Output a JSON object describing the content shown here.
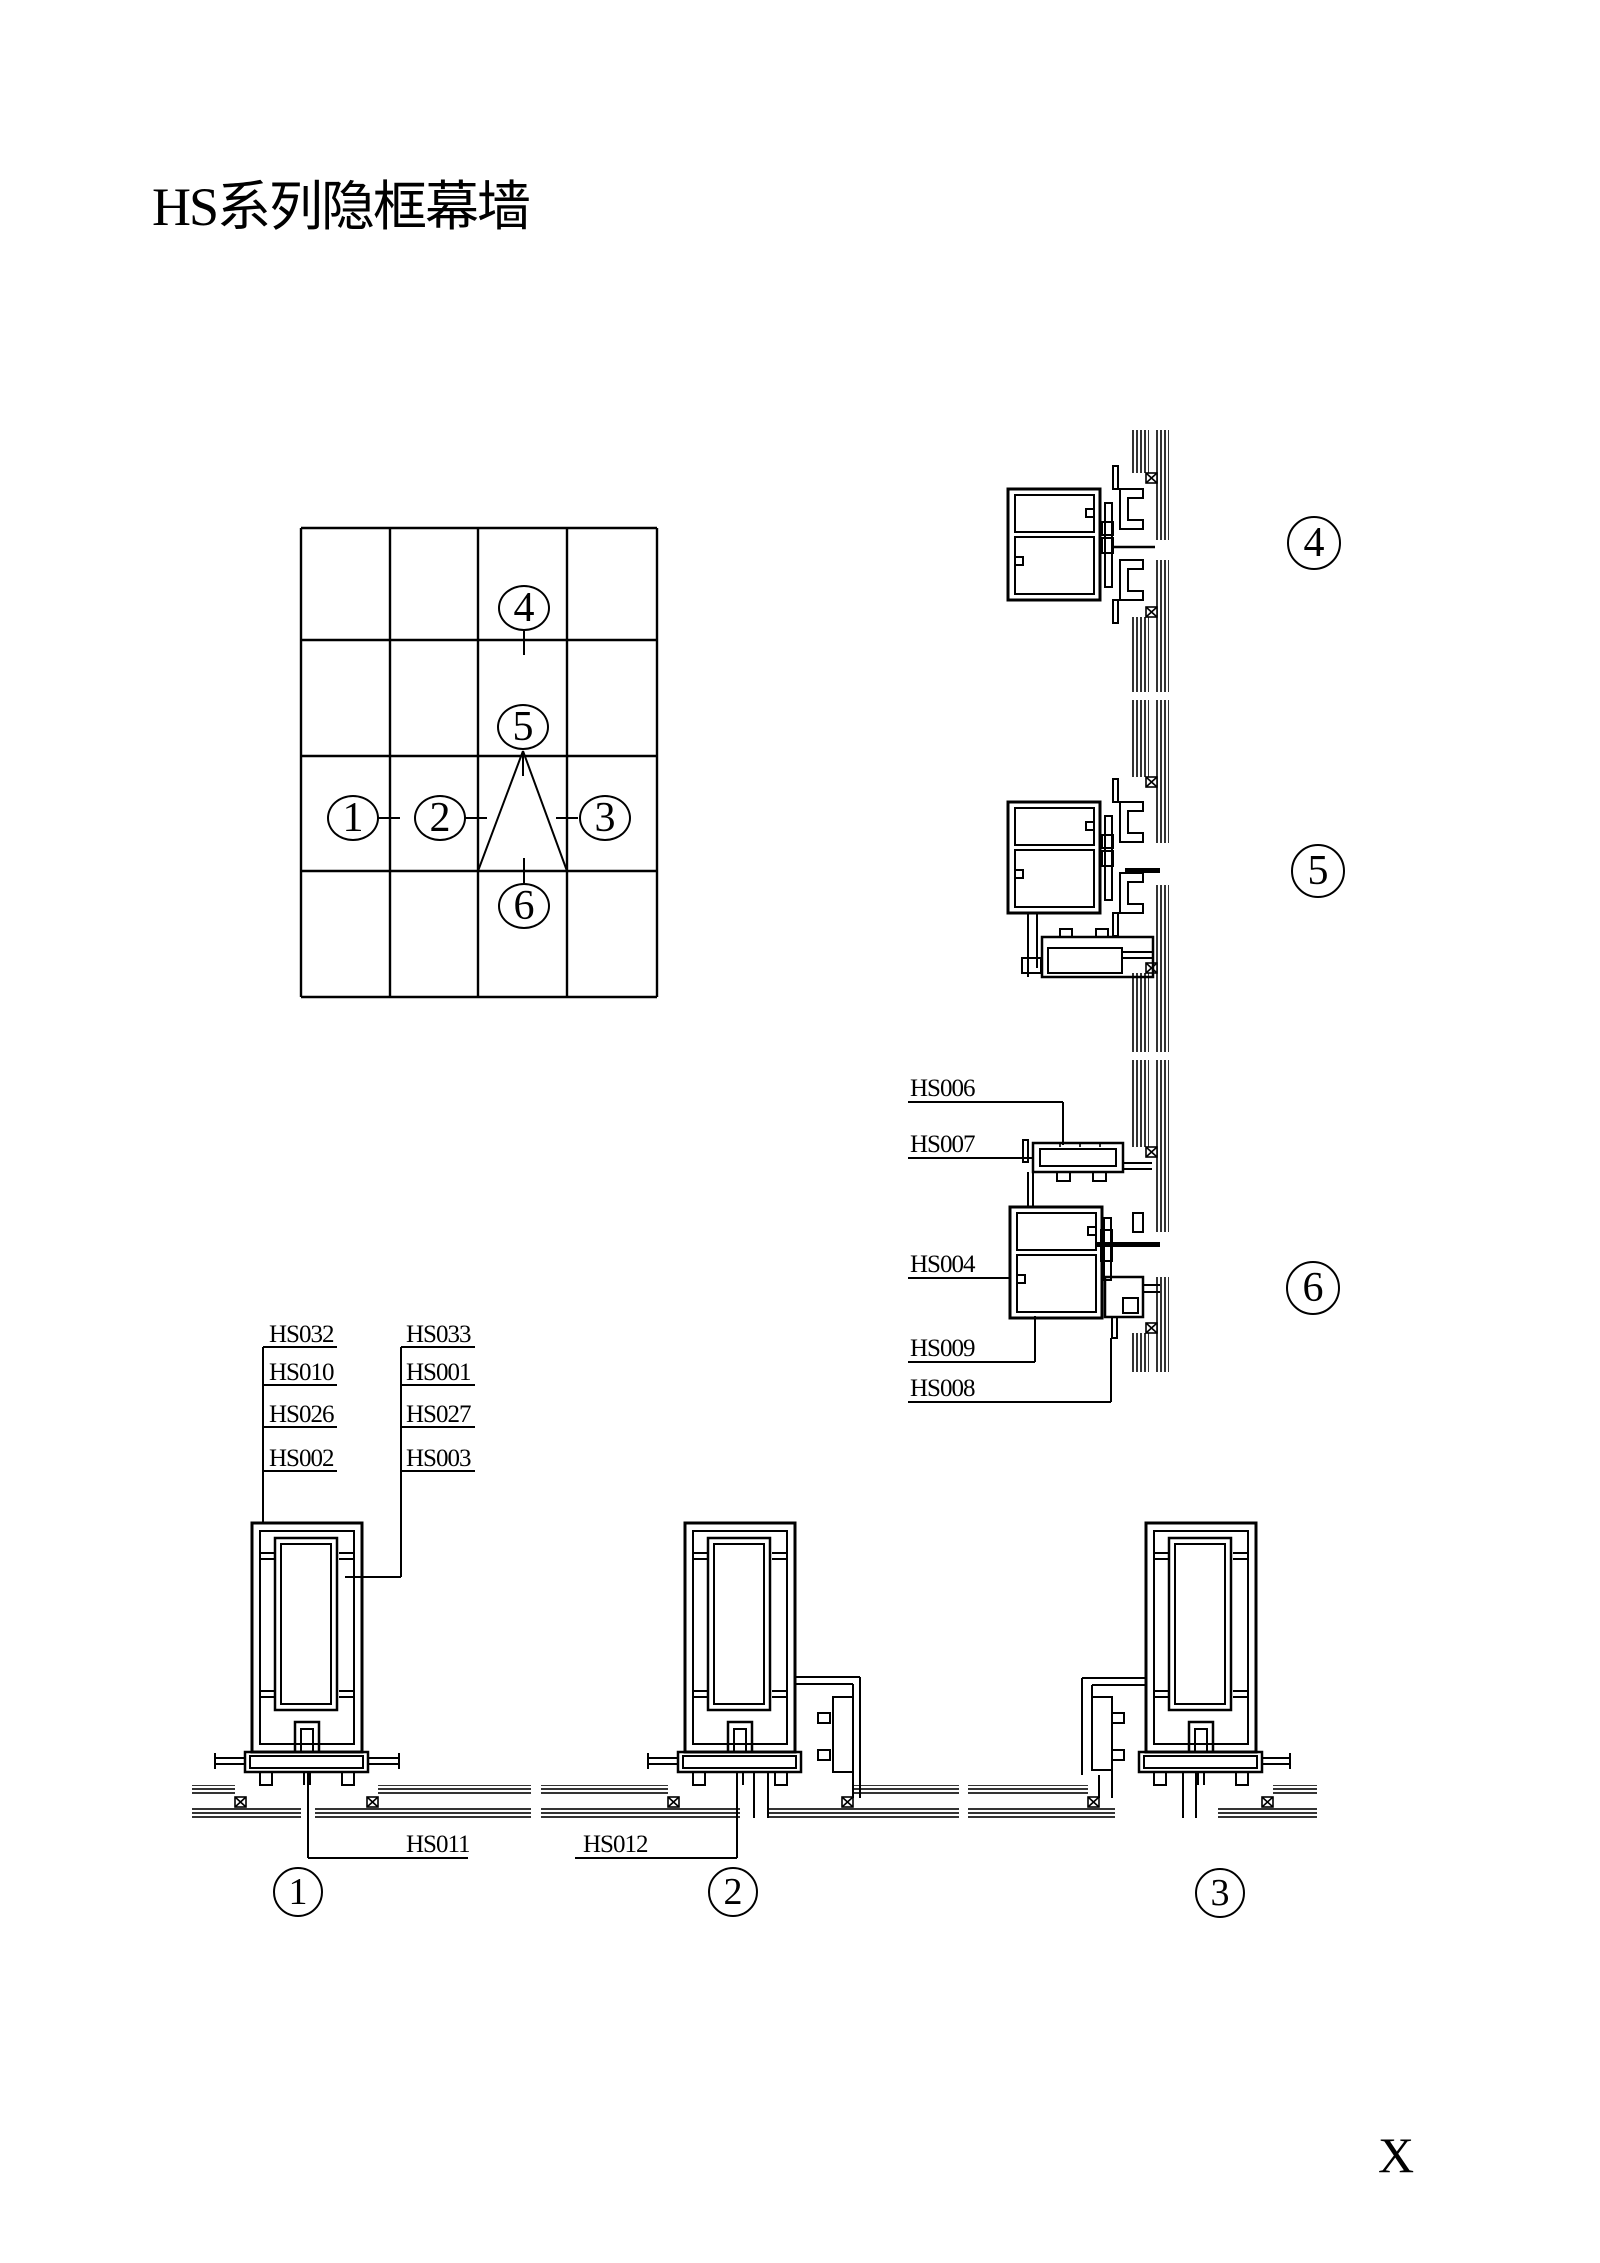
{
  "title": "HS系列隐框幕墙",
  "sheet_letter": "X",
  "plan_grid": {
    "callouts": [
      "1",
      "2",
      "3",
      "4",
      "5",
      "6"
    ]
  },
  "section_markers": {
    "right": [
      "4",
      "5",
      "6"
    ],
    "bottom": [
      "1",
      "2",
      "3"
    ]
  },
  "part_labels": {
    "section6": [
      "HS006",
      "HS007",
      "HS004",
      "HS009",
      "HS008"
    ],
    "stack_left": [
      "HS032",
      "HS010",
      "HS026",
      "HS002"
    ],
    "stack_right": [
      "HS033",
      "HS001",
      "HS027",
      "HS003"
    ],
    "bottom": [
      "HS011",
      "HS012"
    ]
  }
}
